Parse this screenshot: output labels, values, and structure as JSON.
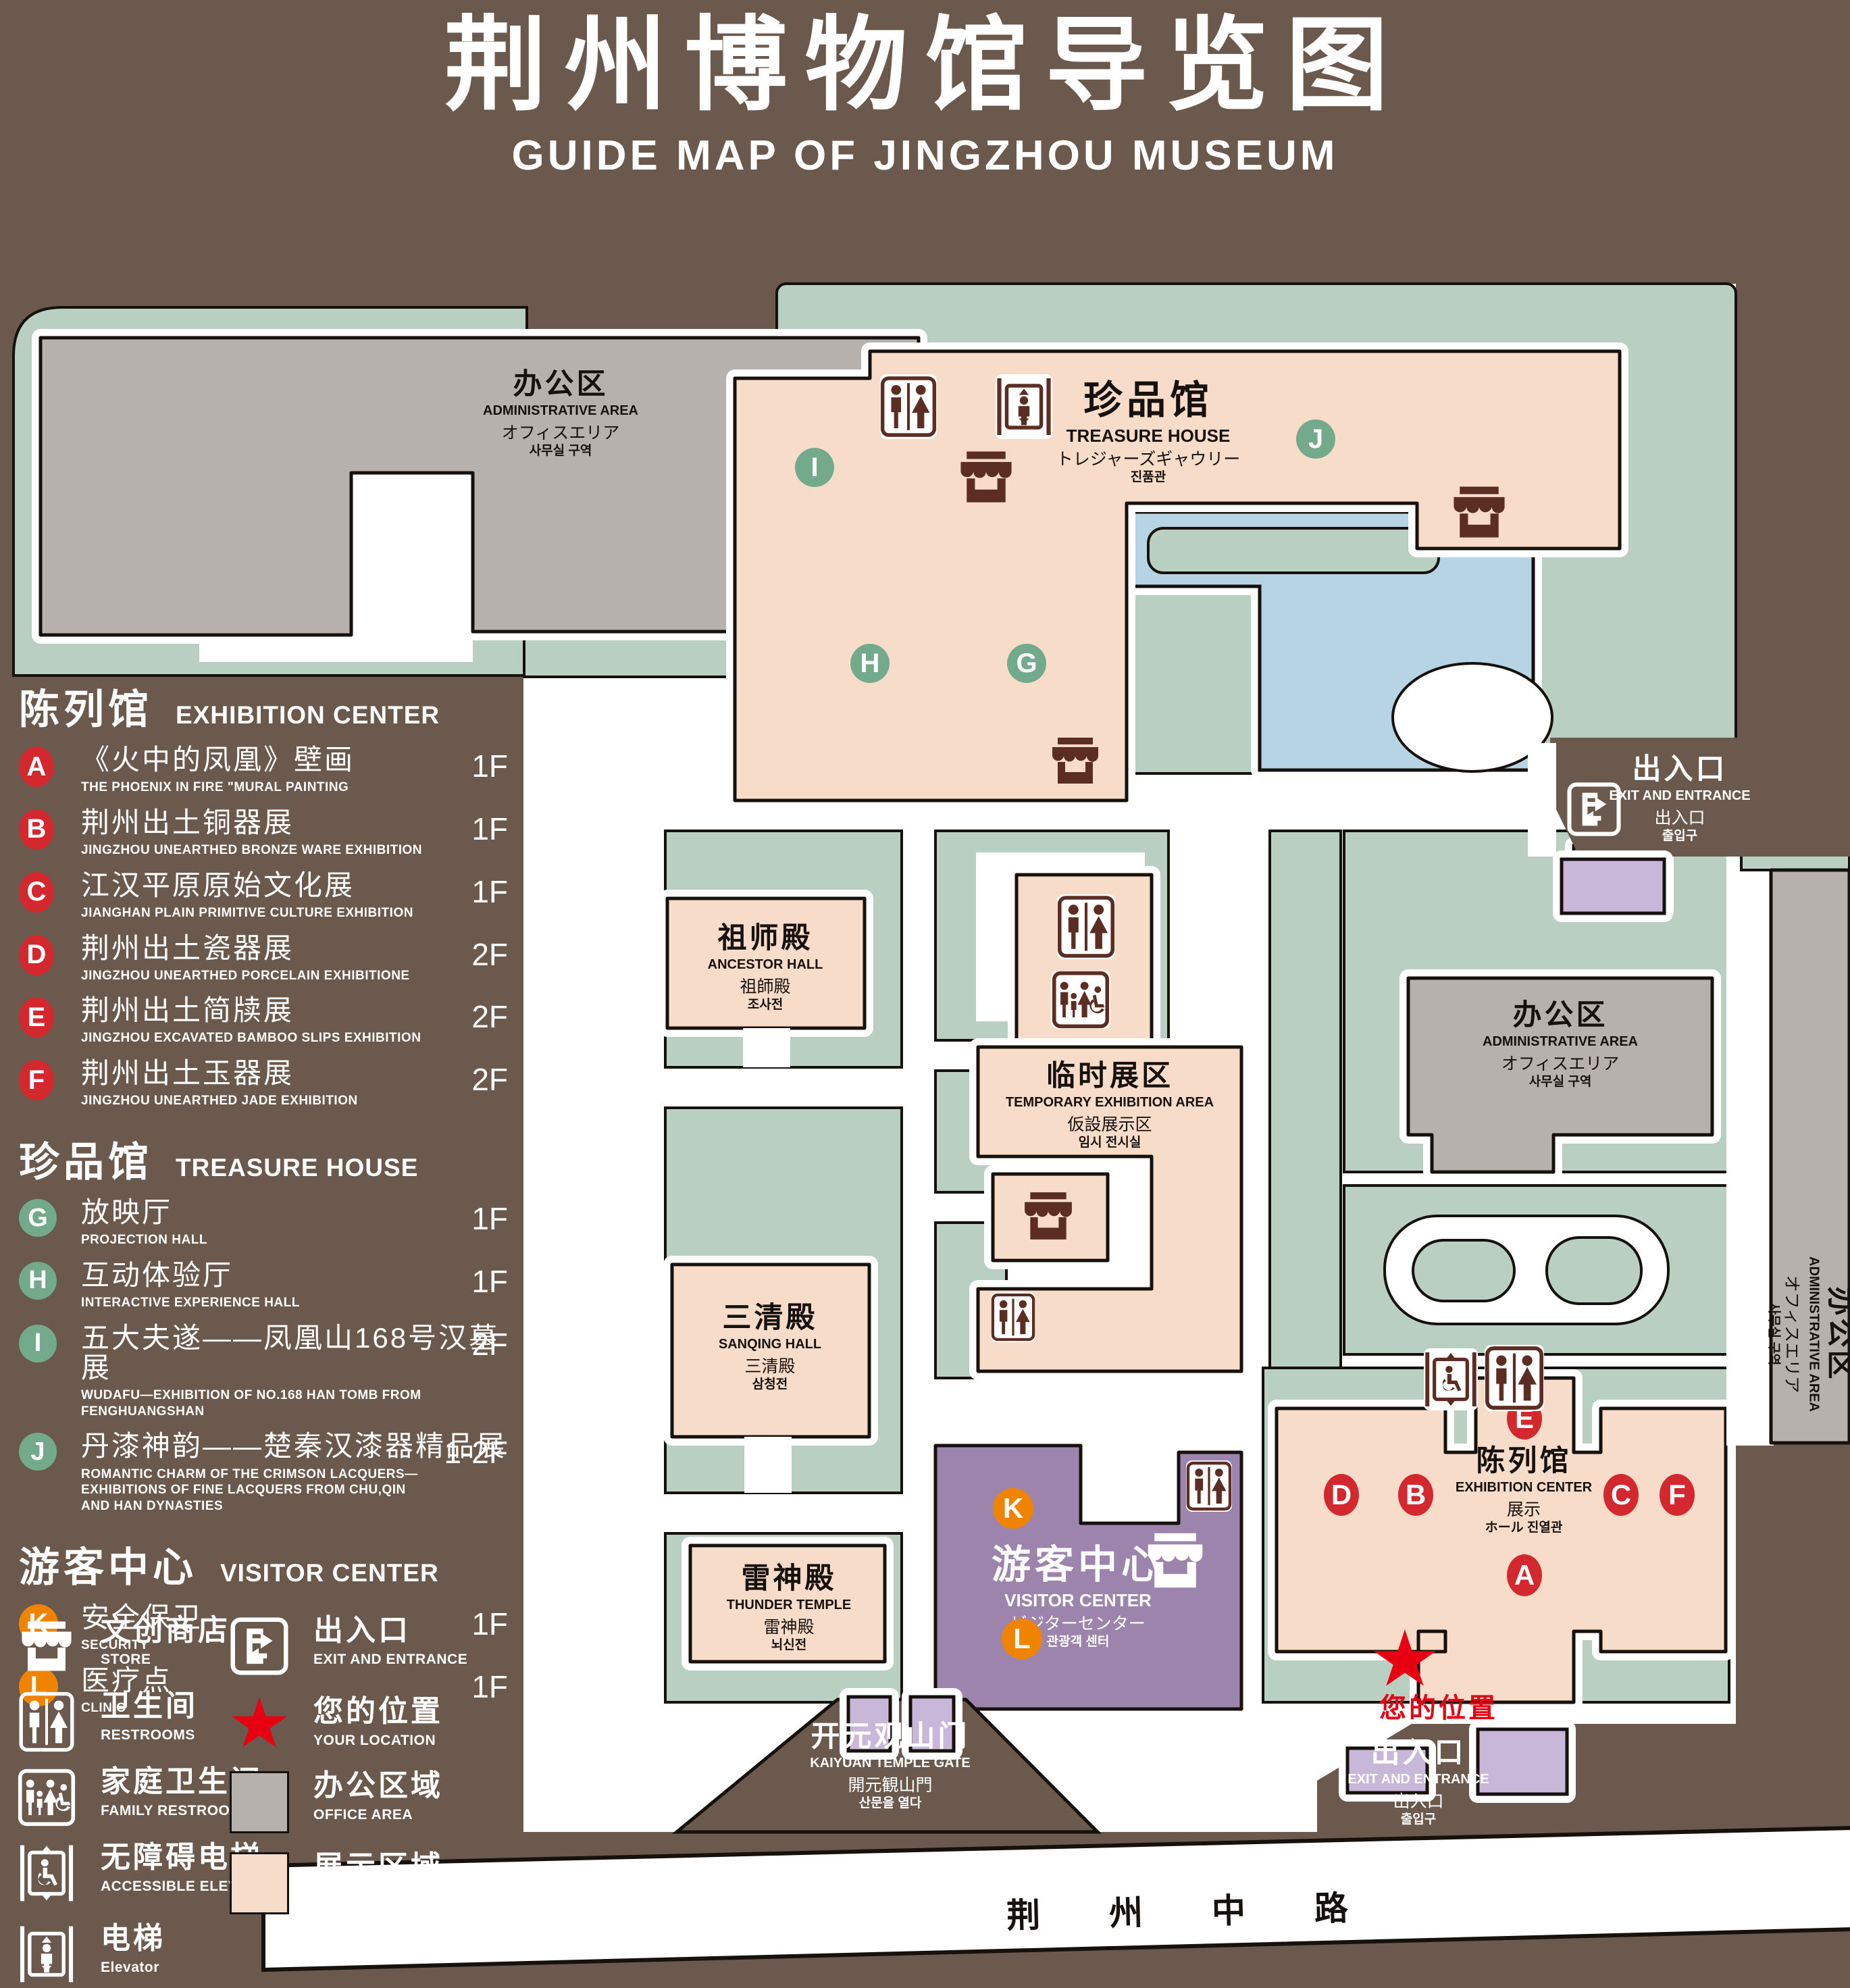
{
  "title": {
    "zh": "荆州博物馆导览图",
    "en": "GUIDE MAP OF JINGZHOU MUSEUM"
  },
  "colors": {
    "background": "#6a594c",
    "lawn": "#b8cfc2",
    "display_area": "#f8dcca",
    "office_area": "#b6b1ad",
    "pond": "#b7d4e4",
    "visitor_center": "#9c84ad",
    "small_building": "#c9b7d9",
    "marker_red": "#d2282e",
    "marker_green": "#74aa8c",
    "marker_orange": "#f08300",
    "icon_dark": "#5b2d23",
    "location_red": "#e60012"
  },
  "legend": {
    "sections": [
      {
        "title_zh": "陈列馆",
        "title_en": "EXHIBITION CENTER",
        "group": "red",
        "items": [
          {
            "key": "A",
            "zh": "《火中的凤凰》壁画",
            "en": "THE PHOENIX IN FIRE \"MURAL PAINTING",
            "floor": "1F"
          },
          {
            "key": "B",
            "zh": "荆州出土铜器展",
            "en": "JINGZHOU UNEARTHED BRONZE WARE EXHIBITION",
            "floor": "1F"
          },
          {
            "key": "C",
            "zh": "江汉平原原始文化展",
            "en": "JIANGHAN PLAIN PRIMITIVE CULTURE EXHIBITION",
            "floor": "1F"
          },
          {
            "key": "D",
            "zh": "荆州出土瓷器展",
            "en": "JINGZHOU UNEARTHED PORCELAIN EXHIBITIONE",
            "floor": "2F"
          },
          {
            "key": "E",
            "zh": "荆州出土简牍展",
            "en": "JINGZHOU EXCAVATED BAMBOO SLIPS EXHIBITION",
            "floor": "2F"
          },
          {
            "key": "F",
            "zh": "荆州出土玉器展",
            "en": "JINGZHOU UNEARTHED JADE EXHIBITION",
            "floor": "2F"
          }
        ]
      },
      {
        "title_zh": "珍品馆",
        "title_en": "TREASURE HOUSE",
        "group": "green",
        "items": [
          {
            "key": "G",
            "zh": "放映厅",
            "en": "PROJECTION HALL",
            "floor": "1F"
          },
          {
            "key": "H",
            "zh": "互动体验厅",
            "en": "INTERACTIVE EXPERIENCE HALL",
            "floor": "1F"
          },
          {
            "key": "I",
            "zh": "五大夫遂——凤凰山168号汉墓展",
            "en": "WUDAFU—EXHIBITION OF NO.168 HAN TOMB FROM FENGHUANGSHAN",
            "floor": "2F"
          },
          {
            "key": "J",
            "zh": "丹漆神韵——楚秦汉漆器精品展",
            "en": "ROMANTIC CHARM OF THE CRIMSON LACQUERS—EXHIBITIONS OF FINE LACQUERS FROM CHU,QIN AND HAN DYNASTIES",
            "floor": "1-2F"
          }
        ]
      },
      {
        "title_zh": "游客中心",
        "title_en": "VISITOR CENTER",
        "group": "orange",
        "items": [
          {
            "key": "K",
            "zh": "安全保卫",
            "en": "SECURITY",
            "floor": "1F"
          },
          {
            "key": "L",
            "zh": "医疗点",
            "en": "CLINIC",
            "floor": "1F"
          }
        ]
      }
    ],
    "icons_left": [
      {
        "icon": "store",
        "zh": "文创商店",
        "en": "STORE"
      },
      {
        "icon": "restroom",
        "zh": "卫生间",
        "en": "RESTROOMS"
      },
      {
        "icon": "family",
        "zh": "家庭卫生间",
        "en": "FAMILY RESTROOMS"
      },
      {
        "icon": "accessible",
        "zh": "无障碍电梯",
        "en": "ACCESSIBLE ELEVATOR"
      },
      {
        "icon": "elevator",
        "zh": "电梯",
        "en": "Elevator"
      }
    ],
    "icons_right": [
      {
        "icon": "exit",
        "zh": "出入口",
        "en": "EXIT AND ENTRANCE"
      },
      {
        "icon": "star",
        "zh": "您的位置",
        "en": "YOUR LOCATION"
      },
      {
        "icon": "office-swatch",
        "zh": "办公区域",
        "en": "OFFICE AREA"
      },
      {
        "icon": "display-swatch",
        "zh": "展示区域",
        "en": "DISPLAY AREA"
      }
    ]
  },
  "map": {
    "labels": {
      "admin": {
        "lines": [
          "办公区",
          "ADMINISTRATIVE AREA",
          "オフィスエリア",
          "사무실 구역"
        ]
      },
      "treasure": {
        "lines": [
          "珍品馆",
          "TREASURE HOUSE",
          "トレジャーズギャウリー",
          "진품관"
        ]
      },
      "ancestor": {
        "lines": [
          "祖师殿",
          "ANCESTOR HALL",
          "祖師殿",
          "조사전"
        ]
      },
      "temporary": {
        "lines": [
          "临时展区",
          "TEMPORARY EXHIBITION AREA",
          "仮設展示区",
          "임시 전시실"
        ]
      },
      "sanqing": {
        "lines": [
          "三清殿",
          "SANQING HALL",
          "三清殿",
          "삼청전"
        ]
      },
      "thunder": {
        "lines": [
          "雷神殿",
          "THUNDER TEMPLE",
          "雷神殿",
          "뇌신전"
        ]
      },
      "visitor": {
        "lines": [
          "游客中心",
          "VISITOR CENTER",
          "ビジターセンター",
          "관광객 센터"
        ]
      },
      "exhibition": {
        "lines": [
          "陈列馆",
          "EXHIBITION CENTER",
          "展示",
          "ホール 진열관"
        ]
      },
      "gate": {
        "lines": [
          "开元观山门",
          "KAIYUAN TEMPLE GATE",
          "開元観山門",
          "산문을 열다"
        ]
      },
      "exit": {
        "lines": [
          "出入口",
          "EXIT AND ENTRANCE",
          "出入口",
          "출입구"
        ]
      }
    },
    "road": "荆 州 中 路",
    "your_location": "您的位置",
    "markers": [
      {
        "key": "A",
        "group": "red"
      },
      {
        "key": "B",
        "group": "red"
      },
      {
        "key": "C",
        "group": "red"
      },
      {
        "key": "D",
        "group": "red"
      },
      {
        "key": "E",
        "group": "red"
      },
      {
        "key": "F",
        "group": "red"
      },
      {
        "key": "G",
        "group": "green"
      },
      {
        "key": "H",
        "group": "green"
      },
      {
        "key": "I",
        "group": "green"
      },
      {
        "key": "J",
        "group": "green"
      },
      {
        "key": "K",
        "group": "orange"
      },
      {
        "key": "L",
        "group": "orange"
      }
    ]
  }
}
